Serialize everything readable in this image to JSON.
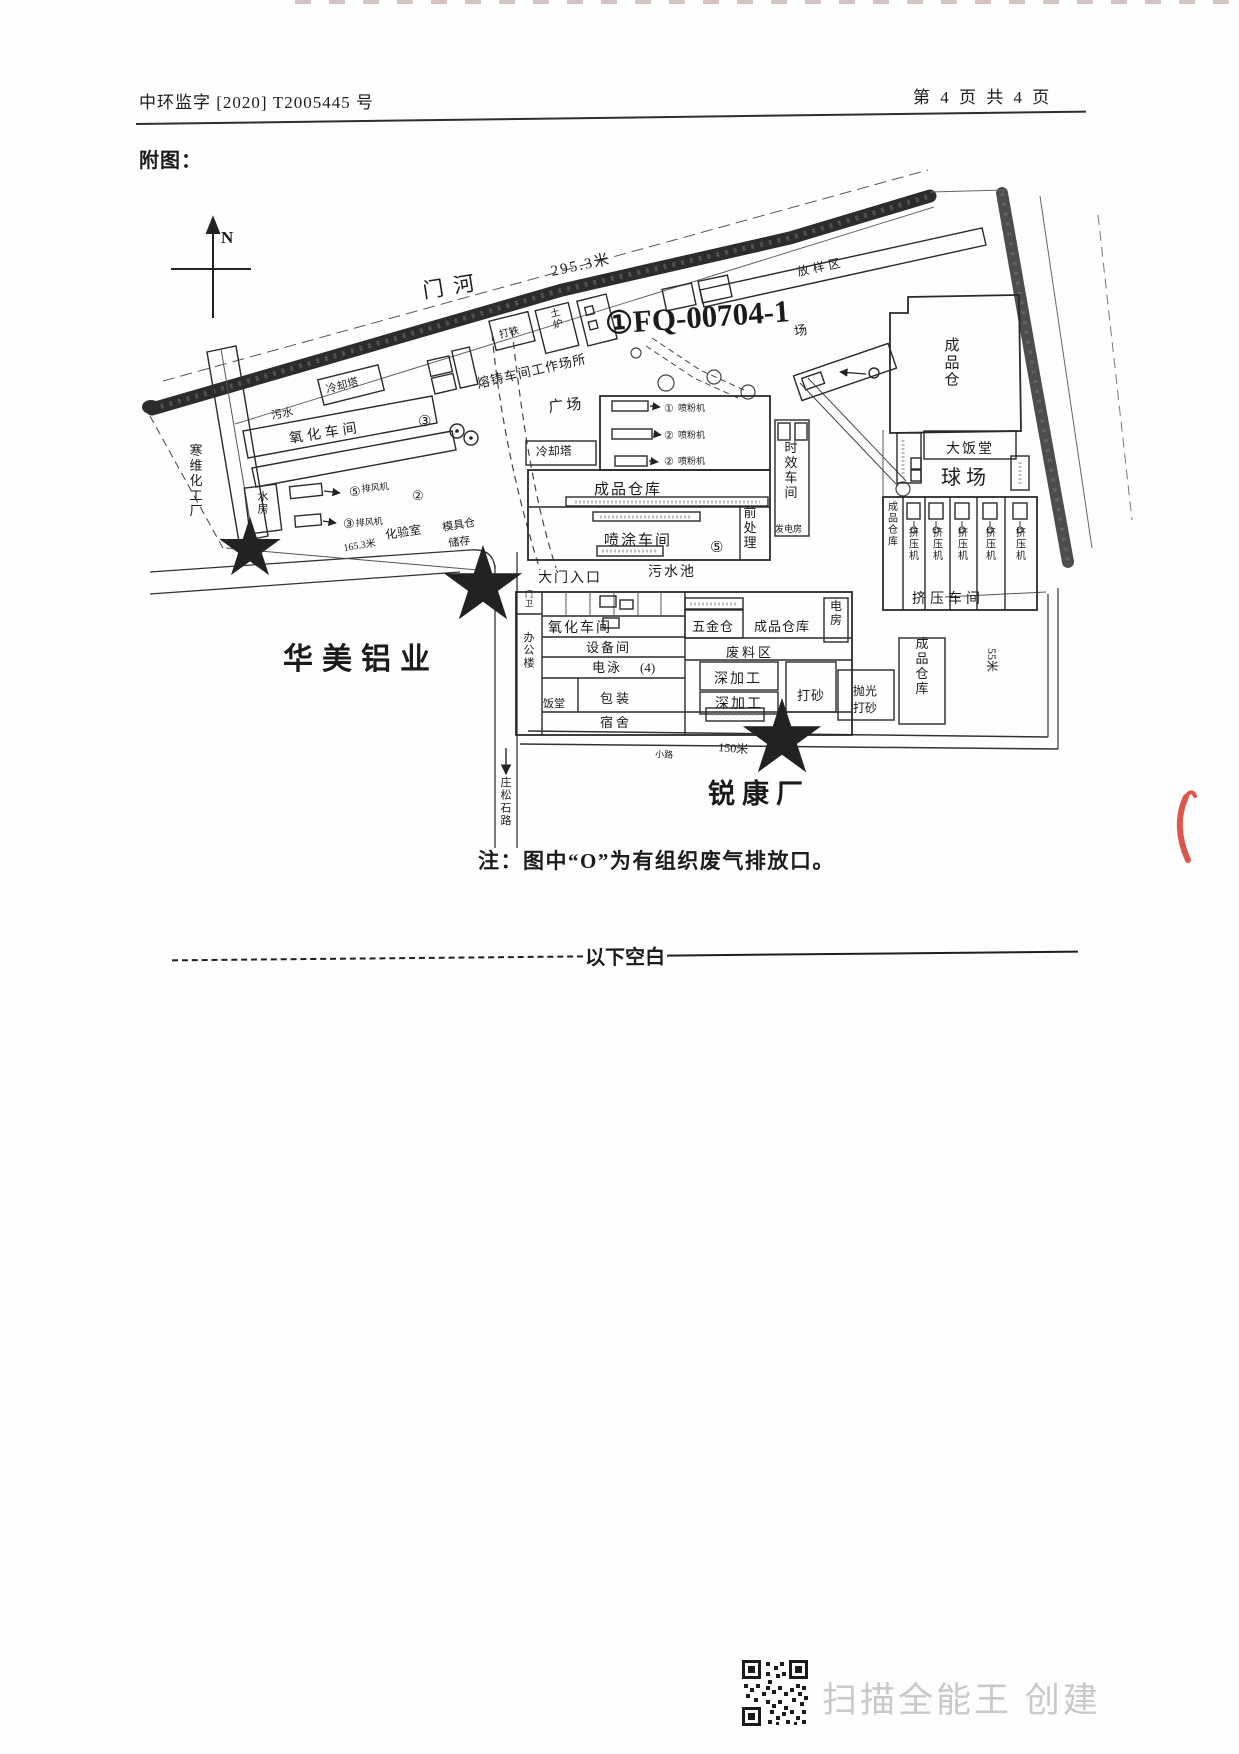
{
  "page": {
    "header": {
      "left": "中环监字 [2020] T2005445 号",
      "right": "第 4 页 共 4 页"
    },
    "figure_title": "附图：",
    "note": "注：图中“O”为有组织废气排放口。",
    "divider_label": "以下空白",
    "watermark": "扫描全能王 创建",
    "accents": {
      "red_pen_mark": "#d63a2e",
      "watermark_gray": "#c9c9c9",
      "map_ink": "#1b1b1b"
    }
  },
  "diagram": {
    "labels": [
      {
        "t": "N",
        "x": 221,
        "y": 243,
        "s": 17,
        "b": 1
      },
      {
        "t": "门河",
        "x": 424,
        "y": 298,
        "s": 21,
        "r": -9,
        "ls": 10
      },
      {
        "t": "295.3米",
        "x": 552,
        "y": 276,
        "s": 15,
        "r": -12,
        "ls": 2
      },
      {
        "t": "①FQ-00704-1",
        "x": 606,
        "y": 334,
        "s": 31,
        "r": -4,
        "b": 1
      },
      {
        "t": "场",
        "x": 795,
        "y": 336,
        "s": 13,
        "r": -10
      },
      {
        "t": "放样区",
        "x": 798,
        "y": 276,
        "s": 12,
        "r": -12,
        "ls": 4
      },
      {
        "t": "熔铸车间工作场所",
        "x": 478,
        "y": 388,
        "s": 13,
        "r": -13,
        "ls": 1
      },
      {
        "t": "打铁",
        "x": 500,
        "y": 338,
        "s": 10,
        "r": -14
      },
      {
        "t": "土炉",
        "x": 556,
        "y": 316,
        "s": 10,
        "r": -14,
        "v": 1
      },
      {
        "t": "广场",
        "x": 549,
        "y": 412,
        "s": 15,
        "r": -6,
        "ls": 3
      },
      {
        "t": "冷却塔",
        "x": 327,
        "y": 393,
        "s": 11,
        "r": -14
      },
      {
        "t": "冷却塔",
        "x": 536,
        "y": 456,
        "s": 12,
        "r": -2
      },
      {
        "t": "氧化车间",
        "x": 290,
        "y": 443,
        "s": 14,
        "r": -9,
        "ls": 4
      },
      {
        "t": "③",
        "x": 418,
        "y": 426,
        "s": 15
      },
      {
        "t": "污水",
        "x": 272,
        "y": 419,
        "s": 11,
        "r": -10
      },
      {
        "t": "寒维化工厂",
        "x": 196,
        "y": 455,
        "s": 13,
        "v": 1
      },
      {
        "t": "水房",
        "x": 263,
        "y": 500,
        "s": 11,
        "v": 1
      },
      {
        "t": "⑤",
        "x": 349,
        "y": 496,
        "s": 13
      },
      {
        "t": "排风机",
        "x": 362,
        "y": 492,
        "s": 9,
        "r": -6
      },
      {
        "t": "③",
        "x": 343,
        "y": 528,
        "s": 13
      },
      {
        "t": "排风机",
        "x": 356,
        "y": 526,
        "s": 9,
        "r": -4
      },
      {
        "t": "②",
        "x": 412,
        "y": 500,
        "s": 13
      },
      {
        "t": "化验室",
        "x": 386,
        "y": 539,
        "s": 12,
        "r": -9
      },
      {
        "t": "模具仓",
        "x": 443,
        "y": 531,
        "s": 11,
        "r": -9
      },
      {
        "t": "储存",
        "x": 449,
        "y": 547,
        "s": 11,
        "r": -9
      },
      {
        "t": "165.3米",
        "x": 344,
        "y": 551,
        "s": 10,
        "r": -9
      },
      {
        "t": "成品仓",
        "x": 952,
        "y": 350,
        "s": 15,
        "v": 1
      },
      {
        "t": "大饭堂",
        "x": 946,
        "y": 453,
        "s": 14,
        "ls": 2
      },
      {
        "t": "球场",
        "x": 941,
        "y": 484,
        "s": 20,
        "ls": 5
      },
      {
        "t": "时效车间",
        "x": 791,
        "y": 452,
        "s": 13,
        "v": 1
      },
      {
        "t": "发电房",
        "x": 775,
        "y": 532,
        "s": 9
      },
      {
        "t": "前处理",
        "x": 750,
        "y": 517,
        "s": 13,
        "v": 1
      },
      {
        "t": "成品仓库",
        "x": 594,
        "y": 494,
        "s": 15,
        "ls": 2
      },
      {
        "t": "喷涂车间",
        "x": 604,
        "y": 545,
        "s": 15,
        "ls": 2
      },
      {
        "t": "⑤",
        "x": 710,
        "y": 552,
        "s": 15
      },
      {
        "t": "大门入口",
        "x": 538,
        "y": 582,
        "s": 14,
        "ls": 2
      },
      {
        "t": "污水池",
        "x": 648,
        "y": 576,
        "s": 14,
        "ls": 2
      },
      {
        "t": "①",
        "x": 664,
        "y": 412,
        "s": 11
      },
      {
        "t": "喷粉机",
        "x": 678,
        "y": 411,
        "s": 9
      },
      {
        "t": "②",
        "x": 664,
        "y": 439,
        "s": 11
      },
      {
        "t": "喷粉机",
        "x": 678,
        "y": 438,
        "s": 9
      },
      {
        "t": "②",
        "x": 664,
        "y": 465,
        "s": 11
      },
      {
        "t": "喷粉机",
        "x": 678,
        "y": 464,
        "s": 9
      },
      {
        "t": "成品仓库",
        "x": 893,
        "y": 510,
        "s": 10,
        "v": 1
      },
      {
        "t": "挤压机",
        "x": 914,
        "y": 536,
        "s": 10,
        "v": 1
      },
      {
        "t": "挤压机",
        "x": 938,
        "y": 536,
        "s": 10,
        "v": 1
      },
      {
        "t": "挤压机",
        "x": 963,
        "y": 536,
        "s": 10,
        "v": 1
      },
      {
        "t": "挤压机",
        "x": 991,
        "y": 536,
        "s": 10,
        "v": 1
      },
      {
        "t": "挤压机",
        "x": 1021,
        "y": 536,
        "s": 10,
        "v": 1
      },
      {
        "t": "挤压车间",
        "x": 912,
        "y": 603,
        "s": 14,
        "ls": 4
      },
      {
        "t": "成品仓库",
        "x": 922,
        "y": 648,
        "s": 13,
        "v": 1
      },
      {
        "t": "55米",
        "x": 988,
        "y": 648,
        "s": 12,
        "r": 90
      },
      {
        "t": "电房",
        "x": 836,
        "y": 610,
        "s": 12,
        "v": 1
      },
      {
        "t": "五金仓",
        "x": 692,
        "y": 631,
        "s": 13,
        "ls": 1
      },
      {
        "t": "成品仓库",
        "x": 754,
        "y": 631,
        "s": 13,
        "ls": 1
      },
      {
        "t": "废料区",
        "x": 726,
        "y": 657,
        "s": 13,
        "ls": 3
      },
      {
        "t": "深加工",
        "x": 714,
        "y": 683,
        "s": 14,
        "ls": 2
      },
      {
        "t": "深加工",
        "x": 715,
        "y": 708,
        "s": 14,
        "ls": 2
      },
      {
        "t": "打砂",
        "x": 797,
        "y": 700,
        "s": 13,
        "ls": 1
      },
      {
        "t": "抛光",
        "x": 853,
        "y": 695,
        "s": 12
      },
      {
        "t": "打砂",
        "x": 853,
        "y": 712,
        "s": 12
      },
      {
        "t": "氧化车间",
        "x": 548,
        "y": 632,
        "s": 14,
        "ls": 2
      },
      {
        "t": "设备间",
        "x": 586,
        "y": 652,
        "s": 13,
        "ls": 2
      },
      {
        "t": "电泳",
        "x": 592,
        "y": 672,
        "s": 13,
        "ls": 2
      },
      {
        "t": "(4)",
        "x": 640,
        "y": 672,
        "s": 13
      },
      {
        "t": "包装",
        "x": 600,
        "y": 703,
        "s": 13,
        "ls": 3
      },
      {
        "t": "饭堂",
        "x": 543,
        "y": 707,
        "s": 11
      },
      {
        "t": "宿舍",
        "x": 600,
        "y": 727,
        "s": 13,
        "ls": 3
      },
      {
        "t": "办公楼",
        "x": 529,
        "y": 641,
        "s": 11,
        "v": 1
      },
      {
        "t": "门卫",
        "x": 529,
        "y": 597,
        "s": 8,
        "v": 1
      },
      {
        "t": "华美铝业",
        "x": 283,
        "y": 669,
        "s": 30,
        "b": 1,
        "ls": 9
      },
      {
        "t": "锐康厂",
        "x": 708,
        "y": 803,
        "s": 27,
        "b": 1,
        "ls": 7
      },
      {
        "t": "庄松石路",
        "x": 506,
        "y": 786,
        "s": 11,
        "v": 1
      },
      {
        "t": "150米",
        "x": 718,
        "y": 751,
        "s": 12,
        "r": 5
      },
      {
        "t": "小路",
        "x": 655,
        "y": 757,
        "s": 9,
        "r": 3
      }
    ]
  }
}
